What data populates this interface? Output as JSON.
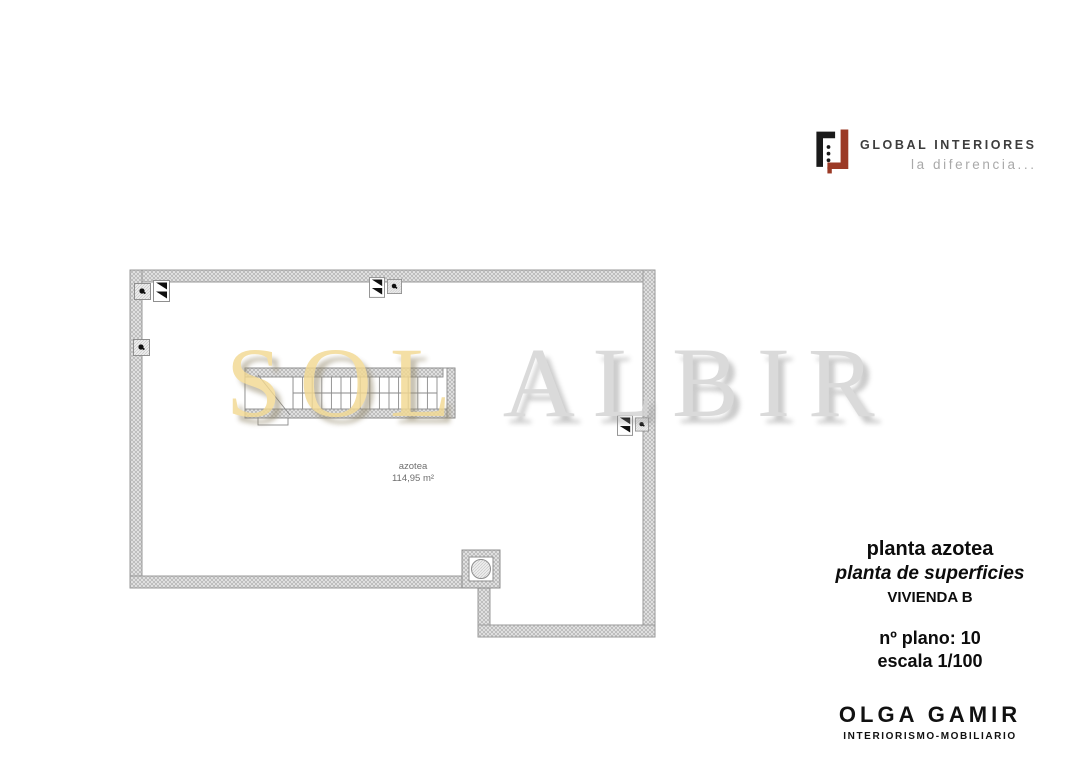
{
  "logo": {
    "brand": "GLOBAL INTERIORES",
    "tagline": "la diferencia...",
    "icon": "global-interiores-mark",
    "colors": {
      "mark_black": "#1a1a1a",
      "mark_red": "#9b3a26",
      "brand_text": "#3d3d3d",
      "tagline_text": "#a9a9a9"
    }
  },
  "watermark": {
    "part1": "SOL",
    "part2": "ALBIR",
    "color1": "#f2d992",
    "color2": "#d3d3d3"
  },
  "plan": {
    "room_label": "azotea",
    "room_area": "114,95 m²",
    "wall_color": "#e6e6e6",
    "hatch_line_color": "#b0b0b0",
    "icons": {
      "drain": "roof-drain-icon",
      "slope": "slope-flag-icon",
      "vent": "chimney-vent-icon"
    }
  },
  "titleblock": {
    "line1": "planta azotea",
    "line2": "planta de superficies",
    "line3": "VIVIENDA B",
    "plan_number": "nº plano: 10",
    "scale": "escala 1/100"
  },
  "studio": {
    "name": "OLGA GAMIR",
    "subtitle": "INTERIORISMO-MOBILIARIO"
  }
}
